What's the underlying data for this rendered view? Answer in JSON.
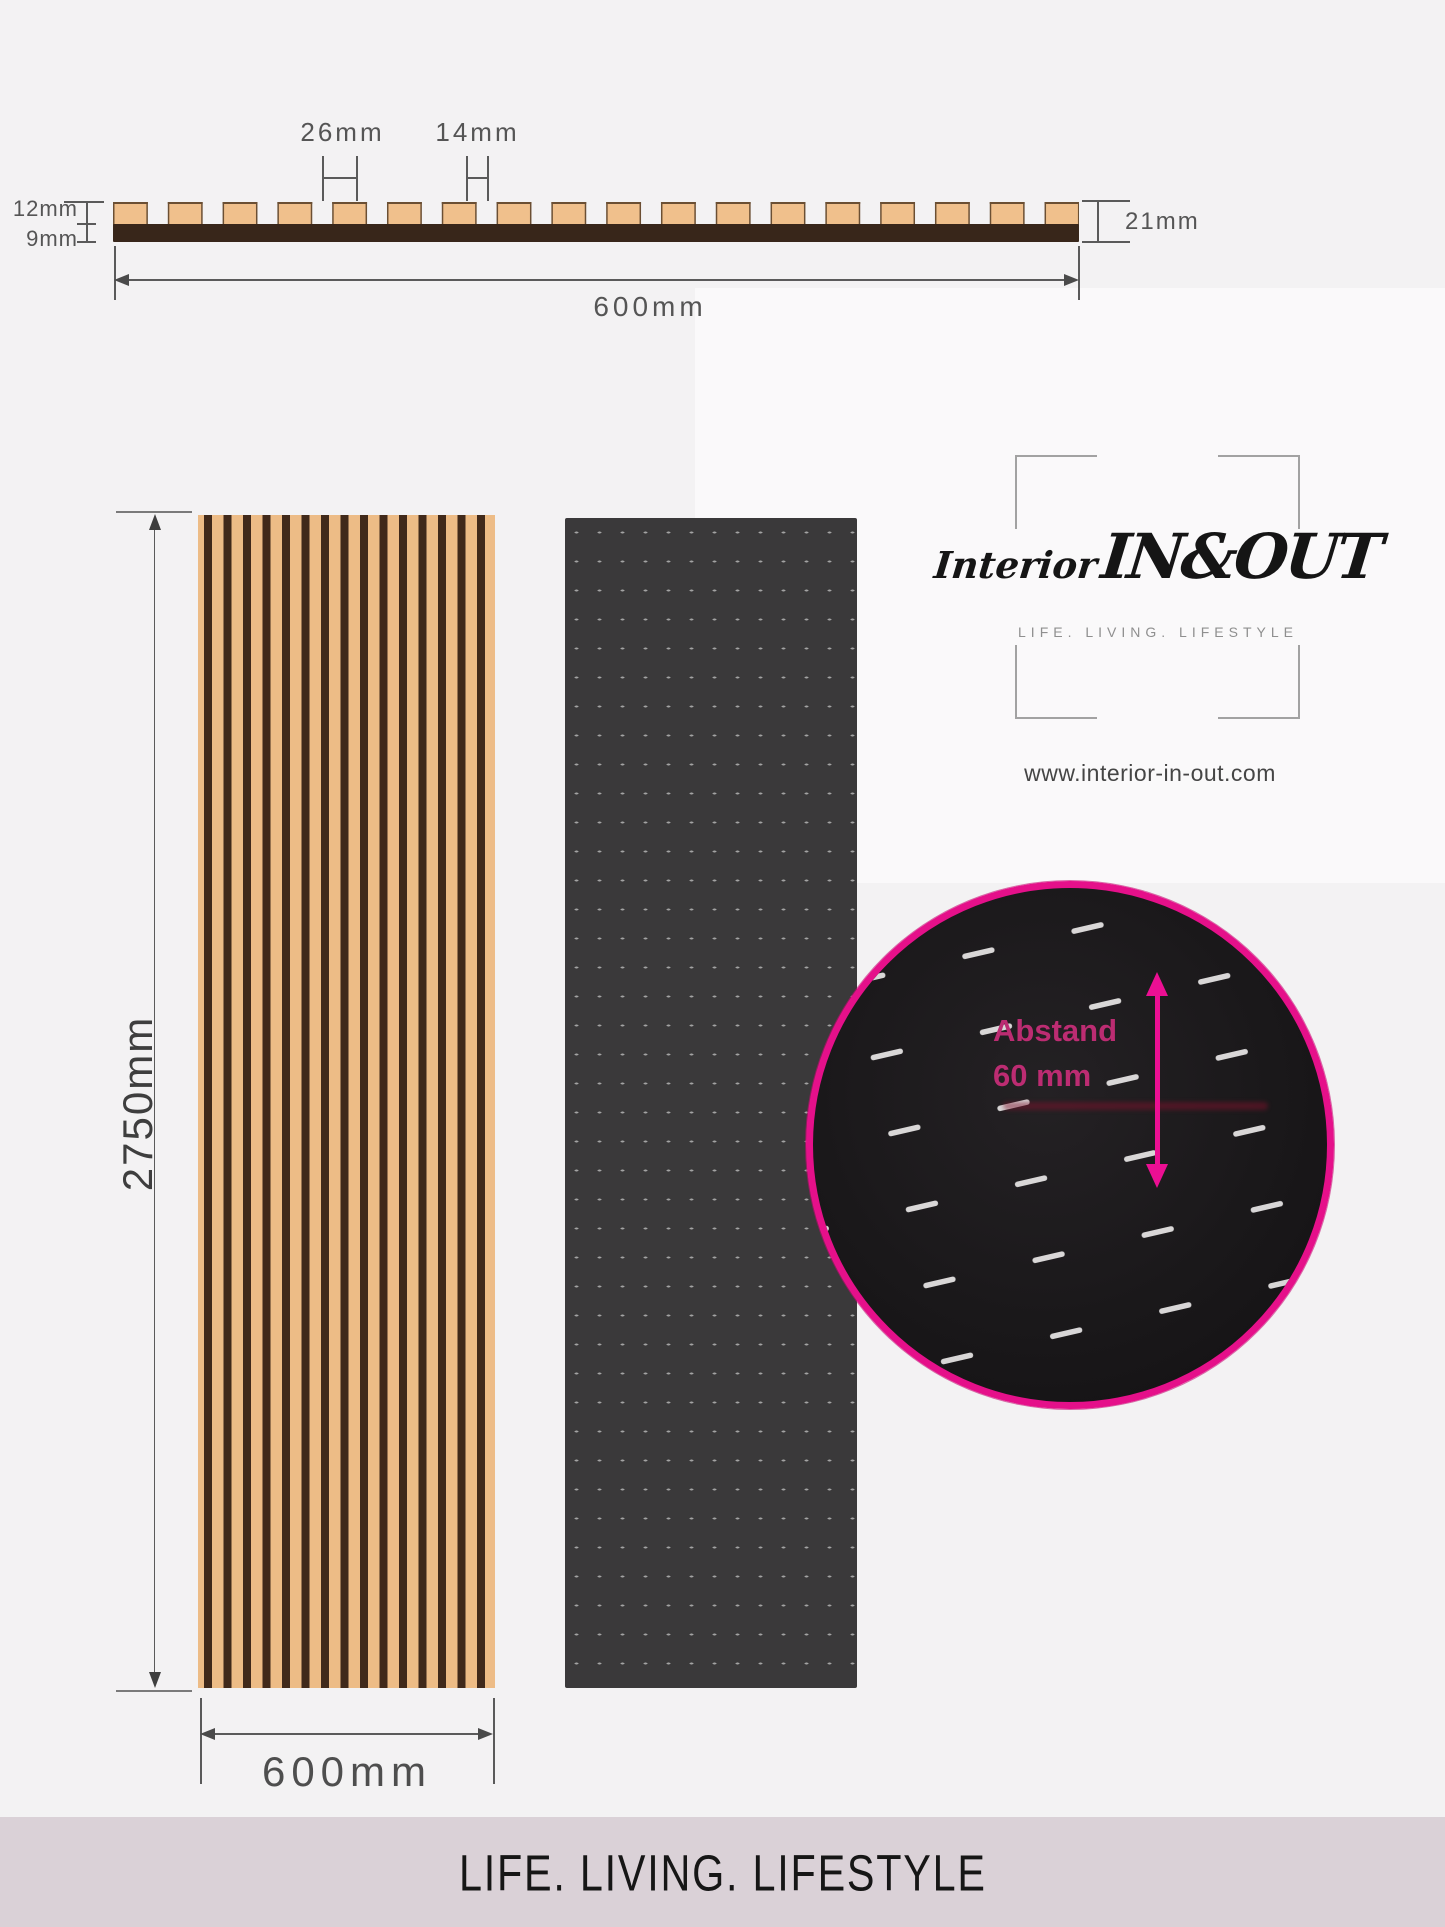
{
  "cross_section": {
    "labels": {
      "slat_width": "26mm",
      "gap_width": "14mm",
      "slat_height": "12mm",
      "base_height": "9mm",
      "total_height": "21mm",
      "total_width": "600mm"
    },
    "colors": {
      "slat": "#F0C08C",
      "slat_outline": "#6B4F33",
      "base": "#38261A"
    }
  },
  "front_view": {
    "height_label": "2750mm",
    "width_label": "600mm",
    "wood_slat_color": "#EDBC86",
    "wood_groove_color": "#40291A",
    "felt_panel_color": "#3A393A",
    "felt_dash_color": "#A3A3A3"
  },
  "magnifier": {
    "annotation_line1": "Abstand",
    "annotation_line2": "60 mm",
    "ring_color": "#E5108A",
    "annotation_color": "#BC2C72"
  },
  "logo": {
    "script_part1": "Interior",
    "script_part2": "IN&OUT",
    "tagline": "LIFE. LIVING. LIFESTYLE",
    "website": "www.interior-in-out.com"
  },
  "footer": {
    "text": "LIFE. LIVING. LIFESTYLE",
    "bg_color": "#DAD1D7"
  }
}
